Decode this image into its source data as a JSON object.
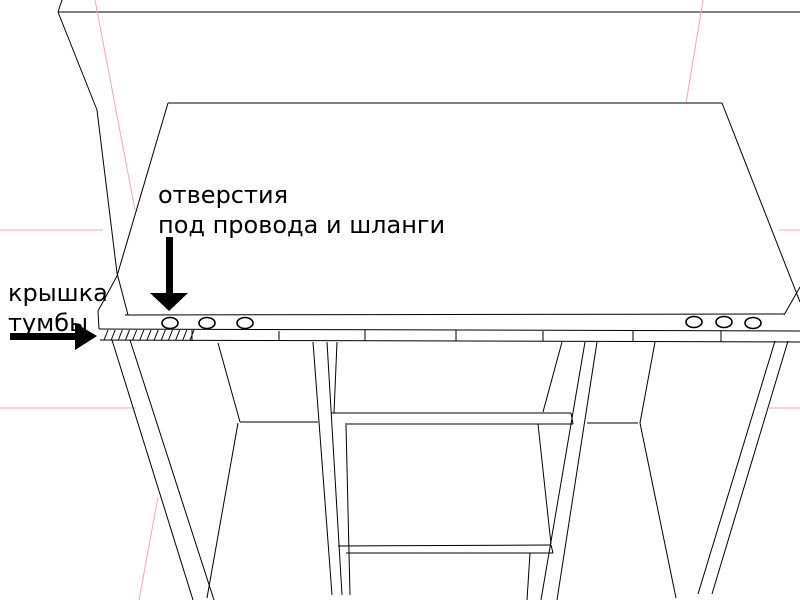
{
  "viewport": {
    "description": "Black-and-white CAD wireframe drawing of a cabinet (tumba) under a desk top, with Russian annotations",
    "width": 800,
    "height": 600
  },
  "annotations": {
    "holes_label": {
      "line1": "отверстия",
      "line2": "под провода и шланги"
    },
    "lid_label": {
      "line1": "крышка",
      "line2": "тумбы"
    }
  },
  "colors": {
    "background": "#ffffff",
    "line": "#000000",
    "axis": "#efadad",
    "annotation": "#000000"
  },
  "drawing": {
    "segments": [
      {
        "x1": 62,
        "y1": 0,
        "x2": 58,
        "y2": 12
      },
      {
        "x1": 58,
        "y1": 12,
        "x2": 800,
        "y2": 12
      },
      {
        "x1": 58,
        "y1": 12,
        "x2": 97,
        "y2": 110
      },
      {
        "x1": 97,
        "y1": 110,
        "x2": 117,
        "y2": 273
      },
      {
        "x1": 117,
        "y1": 273,
        "x2": 128,
        "y2": 315
      },
      {
        "x1": 0,
        "y1": 230,
        "x2": 103,
        "y2": 230,
        "c": "axis"
      },
      {
        "x1": 779,
        "y1": 230,
        "x2": 800,
        "y2": 230,
        "c": "axis"
      },
      {
        "x1": 0,
        "y1": 408,
        "x2": 136,
        "y2": 408,
        "c": "axis"
      },
      {
        "x1": 769,
        "y1": 408,
        "x2": 800,
        "y2": 408,
        "c": "axis"
      },
      {
        "x1": 703,
        "y1": 0,
        "x2": 686,
        "y2": 103,
        "c": "axis"
      },
      {
        "x1": 95,
        "y1": 0,
        "x2": 135,
        "y2": 210,
        "c": "axis"
      },
      {
        "x1": 158,
        "y1": 497,
        "x2": 139,
        "y2": 600,
        "c": "axis"
      },
      {
        "x1": 168,
        "y1": 103,
        "x2": 722,
        "y2": 103
      },
      {
        "x1": 168,
        "y1": 103,
        "x2": 117,
        "y2": 276
      },
      {
        "x1": 117,
        "y1": 276,
        "x2": 98,
        "y2": 311
      },
      {
        "x1": 722,
        "y1": 103,
        "x2": 800,
        "y2": 302
      },
      {
        "x1": 800,
        "y1": 287,
        "x2": 784,
        "y2": 315
      },
      {
        "x1": 125,
        "y1": 315,
        "x2": 784,
        "y2": 314
      },
      {
        "x1": 98,
        "y1": 311,
        "x2": 99,
        "y2": 329
      },
      {
        "x1": 99,
        "y1": 329,
        "x2": 800,
        "y2": 331
      },
      {
        "x1": 100,
        "y1": 340,
        "x2": 800,
        "y2": 342
      },
      {
        "x1": 192,
        "y1": 330,
        "x2": 192,
        "y2": 341
      },
      {
        "x1": 279,
        "y1": 331,
        "x2": 279,
        "y2": 341
      },
      {
        "x1": 365,
        "y1": 330,
        "x2": 365,
        "y2": 341
      },
      {
        "x1": 456,
        "y1": 330,
        "x2": 456,
        "y2": 341
      },
      {
        "x1": 543,
        "y1": 331,
        "x2": 543,
        "y2": 341
      },
      {
        "x1": 633,
        "y1": 331,
        "x2": 633,
        "y2": 342
      },
      {
        "x1": 721,
        "y1": 331,
        "x2": 721,
        "y2": 342
      },
      {
        "x1": 112,
        "y1": 340,
        "x2": 193,
        "y2": 600
      },
      {
        "x1": 130,
        "y1": 340,
        "x2": 214,
        "y2": 600
      },
      {
        "x1": 218,
        "y1": 343,
        "x2": 240,
        "y2": 422
      },
      {
        "x1": 238,
        "y1": 423,
        "x2": 207,
        "y2": 598
      },
      {
        "x1": 240,
        "y1": 422,
        "x2": 318,
        "y2": 422
      },
      {
        "x1": 313,
        "y1": 342,
        "x2": 332,
        "y2": 595
      },
      {
        "x1": 327,
        "y1": 342,
        "x2": 342,
        "y2": 595
      },
      {
        "x1": 337,
        "y1": 342,
        "x2": 334,
        "y2": 413
      },
      {
        "x1": 346,
        "y1": 425,
        "x2": 350,
        "y2": 595
      },
      {
        "x1": 331,
        "y1": 413,
        "x2": 571,
        "y2": 413
      },
      {
        "x1": 345,
        "y1": 424,
        "x2": 573,
        "y2": 424
      },
      {
        "x1": 571,
        "y1": 413,
        "x2": 573,
        "y2": 424
      },
      {
        "x1": 587,
        "y1": 423,
        "x2": 638,
        "y2": 423
      },
      {
        "x1": 562,
        "y1": 342,
        "x2": 543,
        "y2": 412
      },
      {
        "x1": 538,
        "y1": 424,
        "x2": 551,
        "y2": 544
      },
      {
        "x1": 530,
        "y1": 553,
        "x2": 527,
        "y2": 600
      },
      {
        "x1": 585,
        "y1": 342,
        "x2": 541,
        "y2": 600
      },
      {
        "x1": 597,
        "y1": 342,
        "x2": 557,
        "y2": 600
      },
      {
        "x1": 655,
        "y1": 342,
        "x2": 640,
        "y2": 423
      },
      {
        "x1": 640,
        "y1": 423,
        "x2": 676,
        "y2": 598
      },
      {
        "x1": 338,
        "y1": 546,
        "x2": 551,
        "y2": 545
      },
      {
        "x1": 346,
        "y1": 553,
        "x2": 553,
        "y2": 553
      },
      {
        "x1": 551,
        "y1": 545,
        "x2": 553,
        "y2": 553
      },
      {
        "x1": 775,
        "y1": 341,
        "x2": 698,
        "y2": 594
      },
      {
        "x1": 788,
        "y1": 341,
        "x2": 712,
        "y2": 594
      }
    ],
    "holes": [
      {
        "cx": 170,
        "cy": 323,
        "rx": 8,
        "ry": 5.5
      },
      {
        "cx": 207,
        "cy": 323,
        "rx": 8,
        "ry": 5.5
      },
      {
        "cx": 245,
        "cy": 323,
        "rx": 8,
        "ry": 5.5
      },
      {
        "cx": 694,
        "cy": 322,
        "rx": 8,
        "ry": 5.5
      },
      {
        "cx": 724,
        "cy": 322,
        "rx": 8,
        "ry": 5.5
      },
      {
        "cx": 753,
        "cy": 323,
        "rx": 8,
        "ry": 5.5
      }
    ],
    "hatch": {
      "x_start": 104,
      "x_end": 190,
      "count": 13,
      "y_bottom": 340,
      "y_top": 330,
      "lean": 4
    },
    "arrows": [
      {
        "name": "holes-annotation-arrow-down-icon",
        "shaft": {
          "x": 166,
          "y": 237,
          "w": 7,
          "h": 58
        },
        "head": [
          [
            150,
            293
          ],
          [
            188,
            293
          ],
          [
            169,
            311
          ]
        ]
      },
      {
        "name": "lid-annotation-arrow-right-icon",
        "shaft": {
          "x": 10,
          "y": 333,
          "w": 67,
          "h": 7
        },
        "head": [
          [
            75,
            323
          ],
          [
            75,
            350
          ],
          [
            97,
            336
          ]
        ]
      }
    ]
  }
}
